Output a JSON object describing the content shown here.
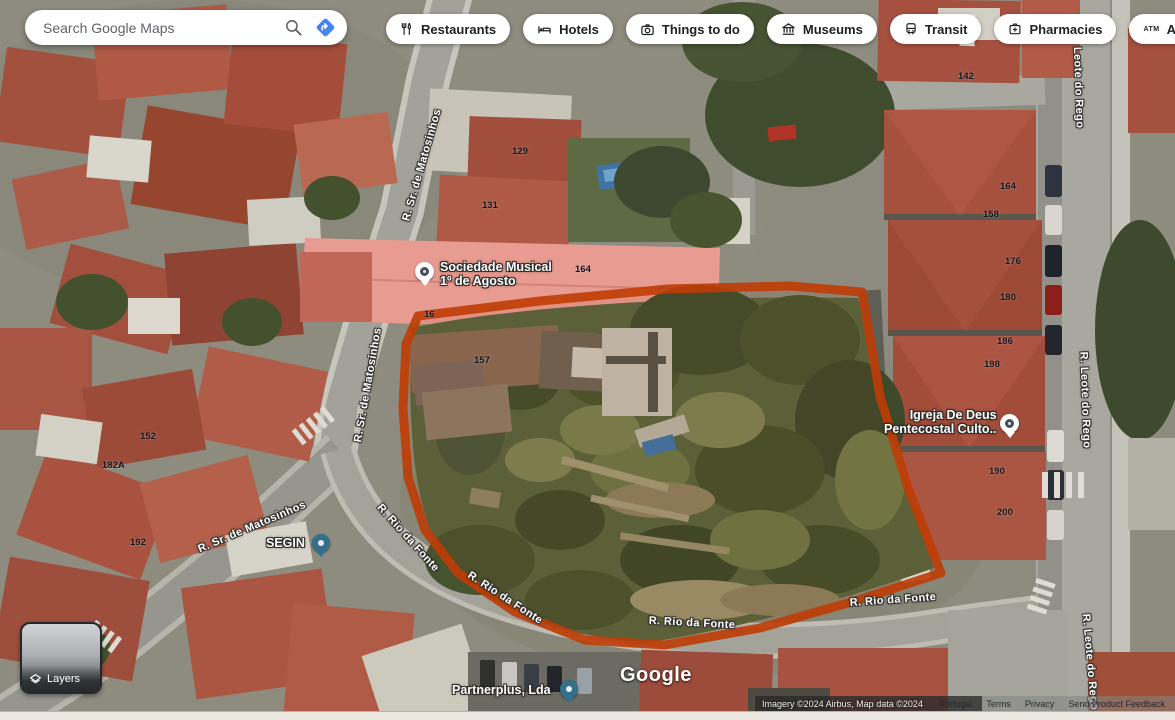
{
  "search": {
    "placeholder": "Search Google Maps"
  },
  "chips": [
    {
      "label": "Restaurants"
    },
    {
      "label": "Hotels"
    },
    {
      "label": "Things to do"
    },
    {
      "label": "Museums"
    },
    {
      "label": "Transit"
    },
    {
      "label": "Pharmacies"
    },
    {
      "label": "ATMs"
    }
  ],
  "map": {
    "pois": [
      {
        "line1": "Sociedade Musical",
        "line2": "1º de Agosto"
      },
      {
        "line1": "Igreja De Deus",
        "line2": "Pentecostal Culto.."
      },
      {
        "line1": "SEGIN",
        "line2": ""
      },
      {
        "line1": "Partnerplus, Lda",
        "line2": ""
      }
    ],
    "street_labels": [
      {
        "text": "R. Sr. de Matosinhos"
      },
      {
        "text": "R. Sr. de Matosinhos"
      },
      {
        "text": "R. Sr. de Matosinhos"
      },
      {
        "text": "R. Rio da Fonte"
      },
      {
        "text": "R. Rio da Fonte"
      },
      {
        "text": "R. Rio da Fonte"
      },
      {
        "text": "R. Rio da Fonte"
      },
      {
        "text": "R. Leote do Rego"
      },
      {
        "text": "R. Leote do Rego"
      },
      {
        "text": "R. Leote do Rego"
      }
    ],
    "house_numbers": [
      {
        "text": "129"
      },
      {
        "text": "131"
      },
      {
        "text": "164"
      },
      {
        "text": "16"
      },
      {
        "text": "157"
      },
      {
        "text": "142"
      },
      {
        "text": "164"
      },
      {
        "text": "158"
      },
      {
        "text": "176"
      },
      {
        "text": "180"
      },
      {
        "text": "186"
      },
      {
        "text": "198"
      },
      {
        "text": "190"
      },
      {
        "text": "200"
      },
      {
        "text": "152"
      },
      {
        "text": "182A"
      },
      {
        "text": "192"
      }
    ],
    "watermark": "Google"
  },
  "layers": {
    "label": "Layers"
  },
  "attribution": {
    "imagery": "Imagery ©2024 Airbus, Map data ©2024",
    "links": [
      "Portugal",
      "Terms",
      "Privacy",
      "Send Product Feedback"
    ]
  },
  "colors": {
    "accent_blue": "#4285f4",
    "boundary": "#bf3c05"
  }
}
